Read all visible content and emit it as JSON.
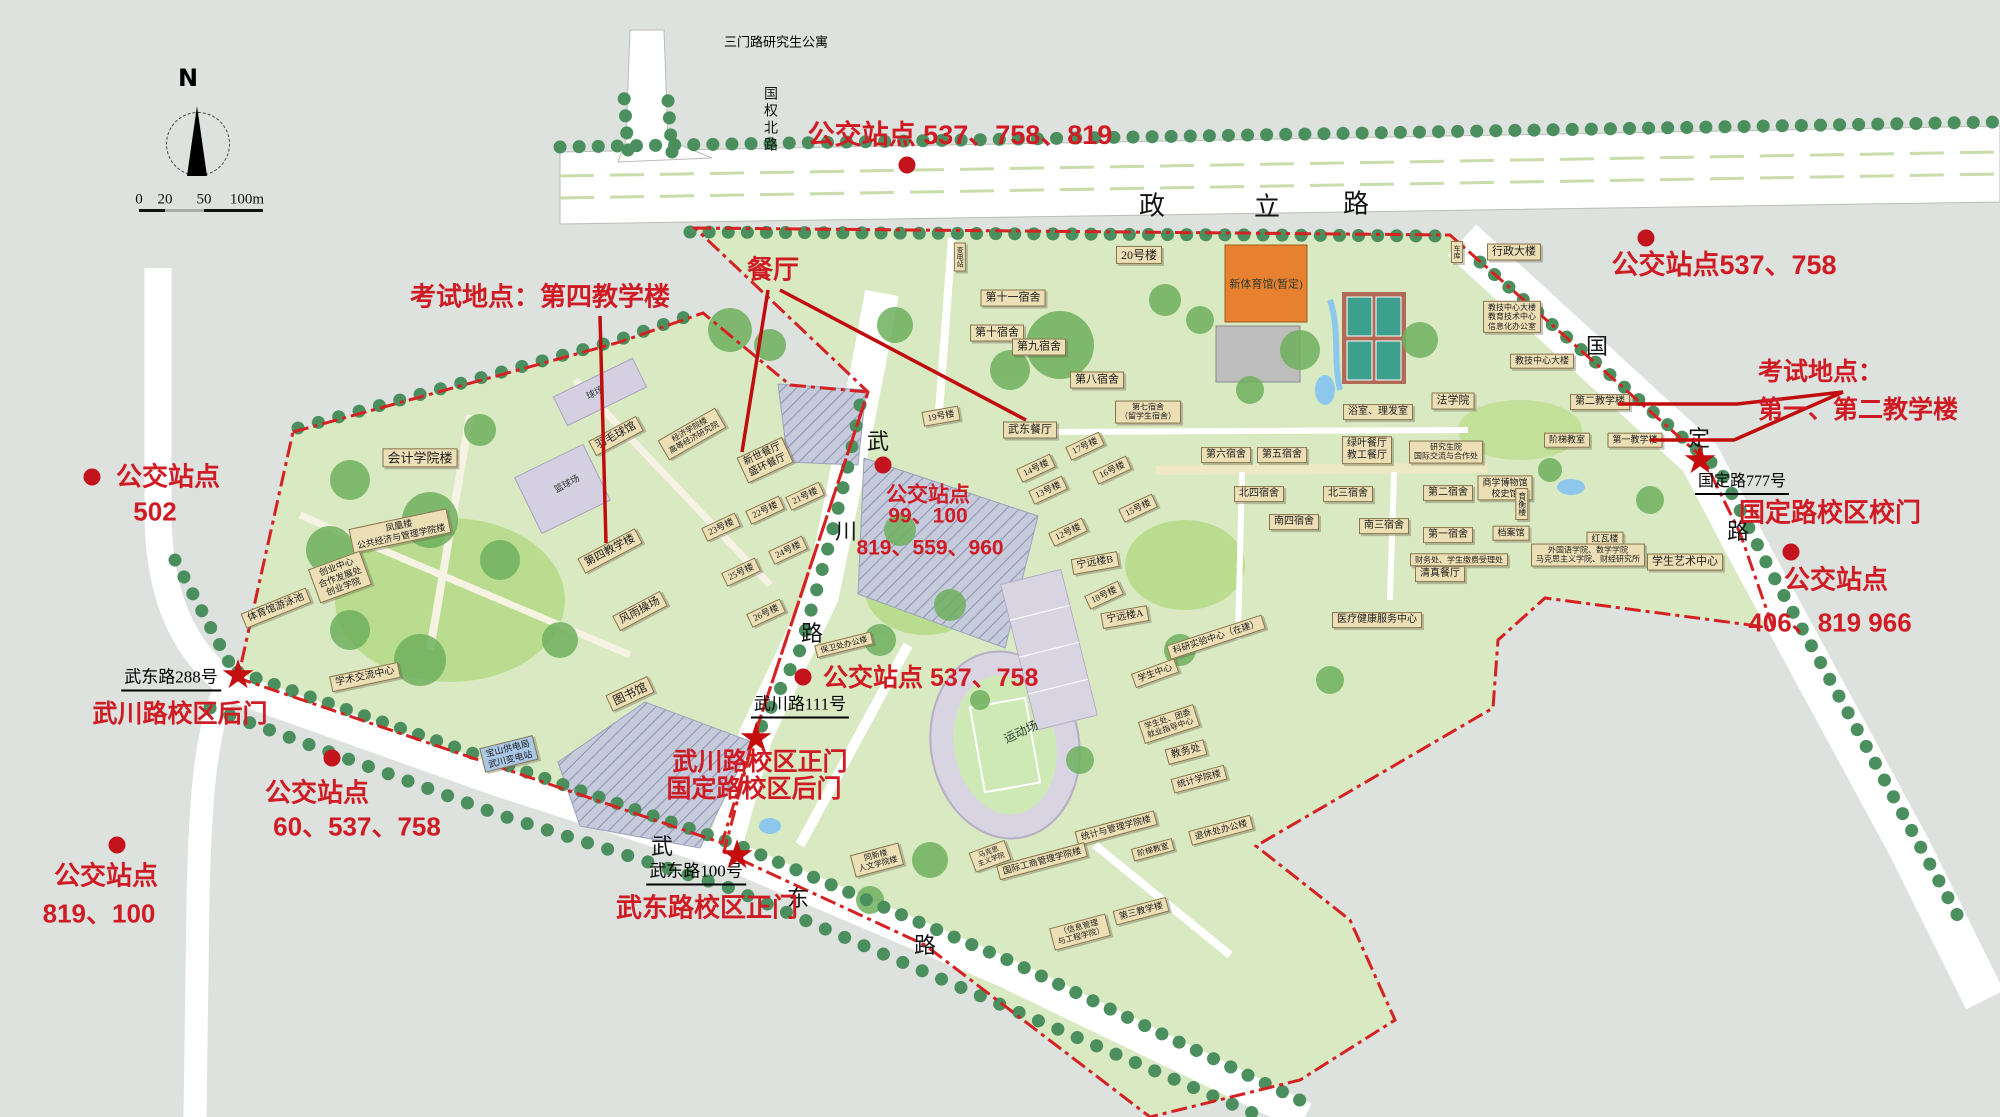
{
  "legend": {
    "north_label": "N",
    "scale_ticks": [
      {
        "t": "0",
        "x": 139,
        "y": 200
      },
      {
        "t": "20",
        "x": 165,
        "y": 200
      },
      {
        "t": "50",
        "x": 204,
        "y": 200
      },
      {
        "t": "100m",
        "x": 247,
        "y": 200
      }
    ]
  },
  "colors": {
    "annotation_red": "#cf1b24",
    "boundary_red": "#d42222",
    "building_tan": "#ecdfb6",
    "campus_green": "#d9e9c2",
    "road_white": "#ffffff",
    "gym_orange": "#e8812f",
    "water_blue": "#8ec7ec",
    "background": "#dde2de"
  },
  "road_names": [
    {
      "t": "政",
      "x": 1152,
      "y": 204,
      "fs": 26
    },
    {
      "t": "立",
      "x": 1267,
      "y": 205,
      "fs": 26
    },
    {
      "t": "路",
      "x": 1356,
      "y": 202,
      "fs": 26
    },
    {
      "t": "国权北路",
      "x": 769,
      "y": 120,
      "fs": 14,
      "vert": true
    },
    {
      "t": "国",
      "x": 1597,
      "y": 345,
      "fs": 22
    },
    {
      "t": "定",
      "x": 1699,
      "y": 437,
      "fs": 22
    },
    {
      "t": "路",
      "x": 1738,
      "y": 530,
      "fs": 22
    },
    {
      "t": "武",
      "x": 878,
      "y": 440,
      "fs": 22
    },
    {
      "t": "川",
      "x": 846,
      "y": 530,
      "fs": 22
    },
    {
      "t": "路",
      "x": 812,
      "y": 632,
      "fs": 22
    },
    {
      "t": "武",
      "x": 662,
      "y": 845,
      "fs": 22
    },
    {
      "t": "东",
      "x": 798,
      "y": 897,
      "fs": 22
    },
    {
      "t": "路",
      "x": 925,
      "y": 944,
      "fs": 22
    }
  ],
  "addresses": [
    {
      "name": "sanmen-road-note",
      "t": "三门路研究生公寓",
      "x": 776,
      "y": 41,
      "fs": 13
    },
    {
      "name": "gate-address-guoding-777",
      "t": "国定路777号",
      "x": 1742,
      "y": 481,
      "fs": 16,
      "u": true
    },
    {
      "name": "gate-address-wuchuan-111",
      "t": "武川路111号",
      "x": 800,
      "y": 704,
      "fs": 17,
      "u": true
    },
    {
      "name": "gate-address-wudong-100",
      "t": "武东路100号",
      "x": 696,
      "y": 871,
      "fs": 17,
      "u": true
    },
    {
      "name": "gate-address-wudong-288",
      "t": "武东路288号",
      "x": 171,
      "y": 677,
      "fs": 17,
      "u": true
    }
  ],
  "annotations": [
    {
      "name": "bus-stop-label",
      "t": "公交站点 537、758、819",
      "x": 960,
      "y": 135,
      "fs": 27
    },
    {
      "name": "bus-stop-label",
      "t": "公交站点537、758",
      "x": 1724,
      "y": 265,
      "fs": 27
    },
    {
      "name": "exam-site-label",
      "t": "考试地点：",
      "x": 1758,
      "y": 372,
      "fs": 25,
      "anchor": "left"
    },
    {
      "name": "exam-site-label",
      "t": "第一、第二教学楼",
      "x": 1758,
      "y": 410,
      "fs": 25,
      "anchor": "left"
    },
    {
      "name": "gate-label",
      "t": "国定路校区校门",
      "x": 1830,
      "y": 513,
      "fs": 26
    },
    {
      "name": "bus-stop-label",
      "t": "公交站点",
      "x": 1836,
      "y": 580,
      "fs": 26
    },
    {
      "name": "bus-stop-label",
      "t": "406、819 966",
      "x": 1830,
      "y": 623,
      "fs": 26
    },
    {
      "name": "exam-site-label",
      "t": "考试地点：第四教学楼",
      "x": 540,
      "y": 297,
      "fs": 26
    },
    {
      "name": "canteen-label",
      "t": "餐厅",
      "x": 773,
      "y": 270,
      "fs": 26
    },
    {
      "name": "bus-stop-label",
      "t": "公交站点",
      "x": 928,
      "y": 495,
      "fs": 21
    },
    {
      "name": "bus-stop-label",
      "t": "99、100",
      "x": 928,
      "y": 516,
      "fs": 21
    },
    {
      "name": "bus-stop-label",
      "t": "819、559、960",
      "x": 930,
      "y": 548,
      "fs": 21
    },
    {
      "name": "bus-stop-label",
      "t": "公交站点 537、758",
      "x": 823,
      "y": 678,
      "fs": 25,
      "anchor": "left"
    },
    {
      "name": "gate-label",
      "t": "武川路校区正门",
      "x": 760,
      "y": 762,
      "fs": 25
    },
    {
      "name": "gate-label",
      "t": "国定路校区后门",
      "x": 754,
      "y": 789,
      "fs": 25
    },
    {
      "name": "gate-label",
      "t": "武东路校区正门",
      "x": 707,
      "y": 908,
      "fs": 26
    },
    {
      "name": "gate-label",
      "t": "武川路校区后门",
      "x": 180,
      "y": 714,
      "fs": 25
    },
    {
      "name": "bus-stop-label",
      "t": "公交站点",
      "x": 168,
      "y": 477,
      "fs": 26
    },
    {
      "name": "bus-stop-label",
      "t": "502",
      "x": 155,
      "y": 512,
      "fs": 26
    },
    {
      "name": "bus-stop-label",
      "t": "公交站点",
      "x": 317,
      "y": 793,
      "fs": 26
    },
    {
      "name": "bus-stop-label",
      "t": "60、537、758",
      "x": 357,
      "y": 827,
      "fs": 26
    },
    {
      "name": "bus-stop-label",
      "t": "公交站点",
      "x": 106,
      "y": 876,
      "fs": 26
    },
    {
      "name": "bus-stop-label",
      "t": "819、100",
      "x": 99,
      "y": 914,
      "fs": 26
    }
  ],
  "bus_dots": [
    {
      "x": 907,
      "y": 165
    },
    {
      "x": 1646,
      "y": 238
    },
    {
      "x": 1791,
      "y": 552
    },
    {
      "x": 883,
      "y": 465
    },
    {
      "x": 803,
      "y": 677
    },
    {
      "x": 92,
      "y": 477
    },
    {
      "x": 332,
      "y": 758
    },
    {
      "x": 117,
      "y": 845
    }
  ],
  "gate_stars": [
    {
      "x": 238,
      "y": 675
    },
    {
      "x": 756,
      "y": 738
    },
    {
      "x": 737,
      "y": 855
    },
    {
      "x": 1700,
      "y": 460
    }
  ],
  "buildings": [
    {
      "t": "会计学院楼",
      "x": 420,
      "y": 458,
      "fs": 13
    },
    {
      "t": "凤凰楼\n公共经济与管理学院楼",
      "x": 400,
      "y": 531,
      "r": -12,
      "fs": 9
    },
    {
      "t": "创业中心\n合作发展处\n创业学院",
      "x": 340,
      "y": 577,
      "r": -20,
      "fs": 9
    },
    {
      "t": "体育馆游泳池",
      "x": 276,
      "y": 608,
      "r": -22,
      "fs": 10
    },
    {
      "t": "学术交流中心",
      "x": 365,
      "y": 677,
      "r": -12,
      "fs": 10
    },
    {
      "t": "球场",
      "x": 595,
      "y": 393,
      "r": -26,
      "fs": 9,
      "bare": true
    },
    {
      "t": "羽毛球馆",
      "x": 616,
      "y": 436,
      "r": -28,
      "fs": 11
    },
    {
      "t": "篮球场",
      "x": 567,
      "y": 484,
      "r": -28,
      "fs": 9,
      "bare": true
    },
    {
      "t": "经济学院楼\n高等经济研究院",
      "x": 692,
      "y": 434,
      "r": -30,
      "fs": 8
    },
    {
      "t": "第四教学楼",
      "x": 610,
      "y": 551,
      "r": -28,
      "fs": 11
    },
    {
      "t": "风雨操场",
      "x": 640,
      "y": 611,
      "r": -28,
      "fs": 11
    },
    {
      "t": "图书馆",
      "x": 630,
      "y": 694,
      "r": -25,
      "fs": 12
    },
    {
      "t": "新世餐厅\n盛环餐厅",
      "x": 765,
      "y": 460,
      "r": -25,
      "fs": 10
    },
    {
      "t": "21号楼",
      "x": 805,
      "y": 496,
      "r": -25,
      "fs": 9
    },
    {
      "t": "22号楼",
      "x": 765,
      "y": 510,
      "r": -25,
      "fs": 9
    },
    {
      "t": "23号楼",
      "x": 721,
      "y": 527,
      "r": -25,
      "fs": 9
    },
    {
      "t": "24号楼",
      "x": 788,
      "y": 550,
      "r": -25,
      "fs": 9
    },
    {
      "t": "25号楼",
      "x": 741,
      "y": 572,
      "r": -25,
      "fs": 9
    },
    {
      "t": "26号楼",
      "x": 766,
      "y": 613,
      "r": -25,
      "fs": 9
    },
    {
      "t": "宝山供电局\n武川变电站",
      "x": 509,
      "y": 754,
      "r": -14,
      "fs": 9,
      "bg": "#a9c7e6"
    },
    {
      "t": "保卫处办公楼",
      "x": 844,
      "y": 645,
      "r": -14,
      "fs": 8
    },
    {
      "t": "20号楼",
      "x": 1139,
      "y": 255,
      "fs": 12
    },
    {
      "t": "新体育馆(暂定)",
      "x": 1266,
      "y": 285,
      "fs": 11,
      "bare": true
    },
    {
      "t": "变电站",
      "x": 960,
      "y": 257,
      "fs": 7,
      "vert": true
    },
    {
      "t": "第十一宿舍",
      "x": 1013,
      "y": 298,
      "fs": 11
    },
    {
      "t": "第十宿舍",
      "x": 997,
      "y": 333,
      "fs": 11
    },
    {
      "t": "第九宿舍",
      "x": 1039,
      "y": 347,
      "fs": 11
    },
    {
      "t": "第八宿舍",
      "x": 1097,
      "y": 380,
      "fs": 11
    },
    {
      "t": "第七宿舍\n（留学生宿舍）",
      "x": 1148,
      "y": 412,
      "fs": 8
    },
    {
      "t": "19号楼",
      "x": 941,
      "y": 416,
      "r": -10,
      "fs": 9
    },
    {
      "t": "武东餐厅",
      "x": 1030,
      "y": 430,
      "fs": 11
    },
    {
      "t": "17号楼",
      "x": 1085,
      "y": 446,
      "r": -25,
      "fs": 9
    },
    {
      "t": "16号楼",
      "x": 1112,
      "y": 470,
      "r": -25,
      "fs": 9
    },
    {
      "t": "14号楼",
      "x": 1036,
      "y": 468,
      "r": -25,
      "fs": 9
    },
    {
      "t": "13号楼",
      "x": 1048,
      "y": 490,
      "r": -25,
      "fs": 9
    },
    {
      "t": "15号楼",
      "x": 1138,
      "y": 508,
      "r": -25,
      "fs": 9
    },
    {
      "t": "12号楼",
      "x": 1068,
      "y": 532,
      "r": -25,
      "fs": 9
    },
    {
      "t": "宁远楼B",
      "x": 1095,
      "y": 563,
      "r": -10,
      "fs": 10
    },
    {
      "t": "18号楼",
      "x": 1104,
      "y": 595,
      "r": -25,
      "fs": 9
    },
    {
      "t": "宁远楼A",
      "x": 1125,
      "y": 617,
      "r": -10,
      "fs": 10
    },
    {
      "t": "浴室、理发室",
      "x": 1378,
      "y": 412,
      "fs": 10
    },
    {
      "t": "法学院",
      "x": 1453,
      "y": 401,
      "fs": 11
    },
    {
      "t": "绿叶餐厅\n教工餐厅",
      "x": 1367,
      "y": 450,
      "fs": 10
    },
    {
      "t": "研究生院\n国际交流与合作处",
      "x": 1446,
      "y": 452,
      "fs": 8
    },
    {
      "t": "第六宿舍",
      "x": 1226,
      "y": 455,
      "fs": 10
    },
    {
      "t": "第五宿舍",
      "x": 1282,
      "y": 455,
      "fs": 10
    },
    {
      "t": "北四宿舍",
      "x": 1259,
      "y": 494,
      "fs": 10
    },
    {
      "t": "南四宿舍",
      "x": 1294,
      "y": 522,
      "fs": 10
    },
    {
      "t": "北三宿舍",
      "x": 1348,
      "y": 494,
      "fs": 10
    },
    {
      "t": "南三宿舍",
      "x": 1384,
      "y": 526,
      "fs": 10
    },
    {
      "t": "第二宿舍",
      "x": 1448,
      "y": 493,
      "fs": 10
    },
    {
      "t": "第一宿舍",
      "x": 1448,
      "y": 535,
      "fs": 10
    },
    {
      "t": "财务处、学生缴费受理处",
      "x": 1459,
      "y": 560,
      "fs": 8
    },
    {
      "t": "清真餐厅",
      "x": 1440,
      "y": 574,
      "fs": 10
    },
    {
      "t": "医疗健康服务中心",
      "x": 1377,
      "y": 620,
      "fs": 10
    },
    {
      "t": "行政大楼",
      "x": 1514,
      "y": 252,
      "fs": 11
    },
    {
      "t": "车库",
      "x": 1457,
      "y": 252,
      "fs": 7,
      "vert": true
    },
    {
      "t": "教技中心大楼\n教育技术中心\n信息化办公室",
      "x": 1512,
      "y": 317,
      "fs": 8
    },
    {
      "t": "教技中心大楼",
      "x": 1542,
      "y": 361,
      "fs": 9
    },
    {
      "t": "第二教学楼",
      "x": 1600,
      "y": 402,
      "fs": 10
    },
    {
      "t": "阶梯教室",
      "x": 1567,
      "y": 440,
      "fs": 9
    },
    {
      "t": "第一教学楼",
      "x": 1635,
      "y": 440,
      "fs": 9
    },
    {
      "t": "商学博物馆\n校史馆",
      "x": 1505,
      "y": 488,
      "fs": 9
    },
    {
      "t": "育衡楼",
      "x": 1522,
      "y": 504,
      "fs": 8,
      "vert": true
    },
    {
      "t": "档案馆",
      "x": 1511,
      "y": 533,
      "fs": 9
    },
    {
      "t": "红瓦楼",
      "x": 1605,
      "y": 539,
      "fs": 9
    },
    {
      "t": "外国语学院、数学学院\n马克思主义学院、财经研究所",
      "x": 1588,
      "y": 555,
      "fs": 8
    },
    {
      "t": "学生艺术中心",
      "x": 1685,
      "y": 562,
      "fs": 11
    },
    {
      "t": "科研实验中心（在建）",
      "x": 1216,
      "y": 637,
      "r": -18,
      "fs": 9
    },
    {
      "t": "学生中心",
      "x": 1155,
      "y": 673,
      "r": -20,
      "fs": 9
    },
    {
      "t": "学生处、团委\n就业指导中心",
      "x": 1169,
      "y": 724,
      "r": -18,
      "fs": 8
    },
    {
      "t": "教务处",
      "x": 1186,
      "y": 752,
      "r": -15,
      "fs": 10
    },
    {
      "t": "统计学院楼",
      "x": 1199,
      "y": 779,
      "r": -15,
      "fs": 9
    },
    {
      "t": "退休处办公楼",
      "x": 1221,
      "y": 830,
      "r": -15,
      "fs": 9
    },
    {
      "t": "统计与管理学院楼",
      "x": 1116,
      "y": 828,
      "r": -15,
      "fs": 9
    },
    {
      "t": "阶梯教室",
      "x": 1153,
      "y": 850,
      "r": -15,
      "fs": 8
    },
    {
      "t": "国际工商管理学院楼",
      "x": 1042,
      "y": 861,
      "r": -15,
      "fs": 9
    },
    {
      "t": "马克思\n主义学院",
      "x": 990,
      "y": 856,
      "r": -20,
      "fs": 7
    },
    {
      "t": "同新楼\n人文学院楼",
      "x": 877,
      "y": 860,
      "r": -15,
      "fs": 8
    },
    {
      "t": "运动场",
      "x": 1021,
      "y": 732,
      "r": -25,
      "fs": 12,
      "bare": true
    },
    {
      "t": "第三教学楼",
      "x": 1141,
      "y": 911,
      "r": -15,
      "fs": 9
    },
    {
      "t": "（信息管理\n与工程学院）",
      "x": 1080,
      "y": 932,
      "r": -15,
      "fs": 8
    }
  ]
}
